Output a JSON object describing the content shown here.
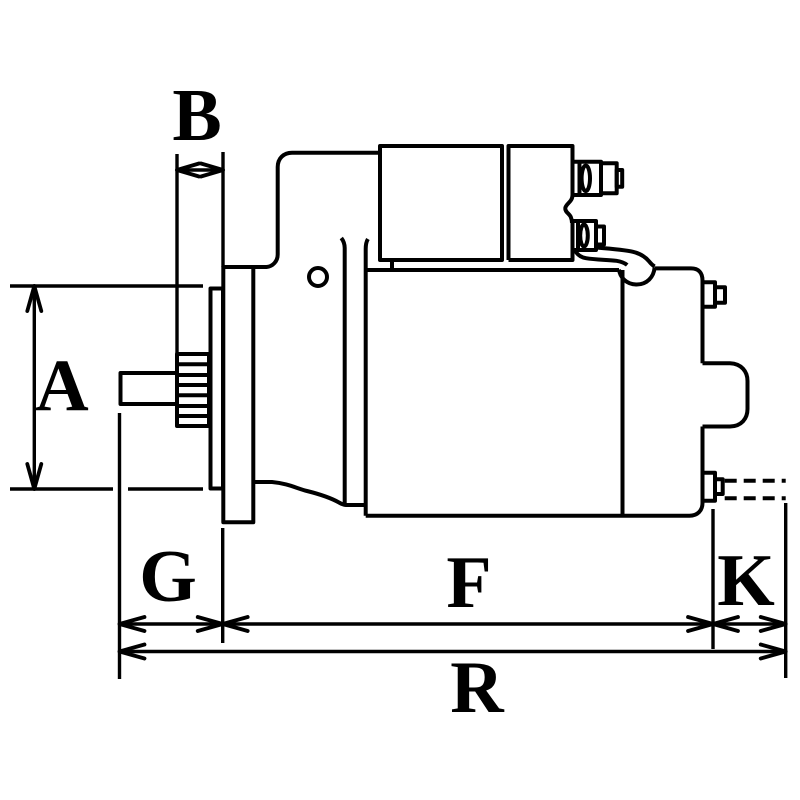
{
  "colors": {
    "background": "#ffffff",
    "line": "#000000",
    "text": "#000000"
  },
  "drawing": {
    "type": "technical-dimension-line-drawing",
    "subject": "starter-motor-side-view"
  },
  "dimension_labels": [
    {
      "id": "A",
      "text": "A",
      "axis": "vertical",
      "region": "left-pinion-diameter"
    },
    {
      "id": "B",
      "text": "B",
      "axis": "horizontal",
      "region": "top-left-pinion-to-flange"
    },
    {
      "id": "G",
      "text": "G",
      "axis": "horizontal",
      "region": "bottom-left-segment"
    },
    {
      "id": "F",
      "text": "F",
      "axis": "horizontal",
      "region": "bottom-middle-segment"
    },
    {
      "id": "K",
      "text": "K",
      "axis": "horizontal",
      "region": "bottom-right-segment"
    },
    {
      "id": "R",
      "text": "R",
      "axis": "horizontal",
      "region": "bottom-overall-length"
    }
  ]
}
